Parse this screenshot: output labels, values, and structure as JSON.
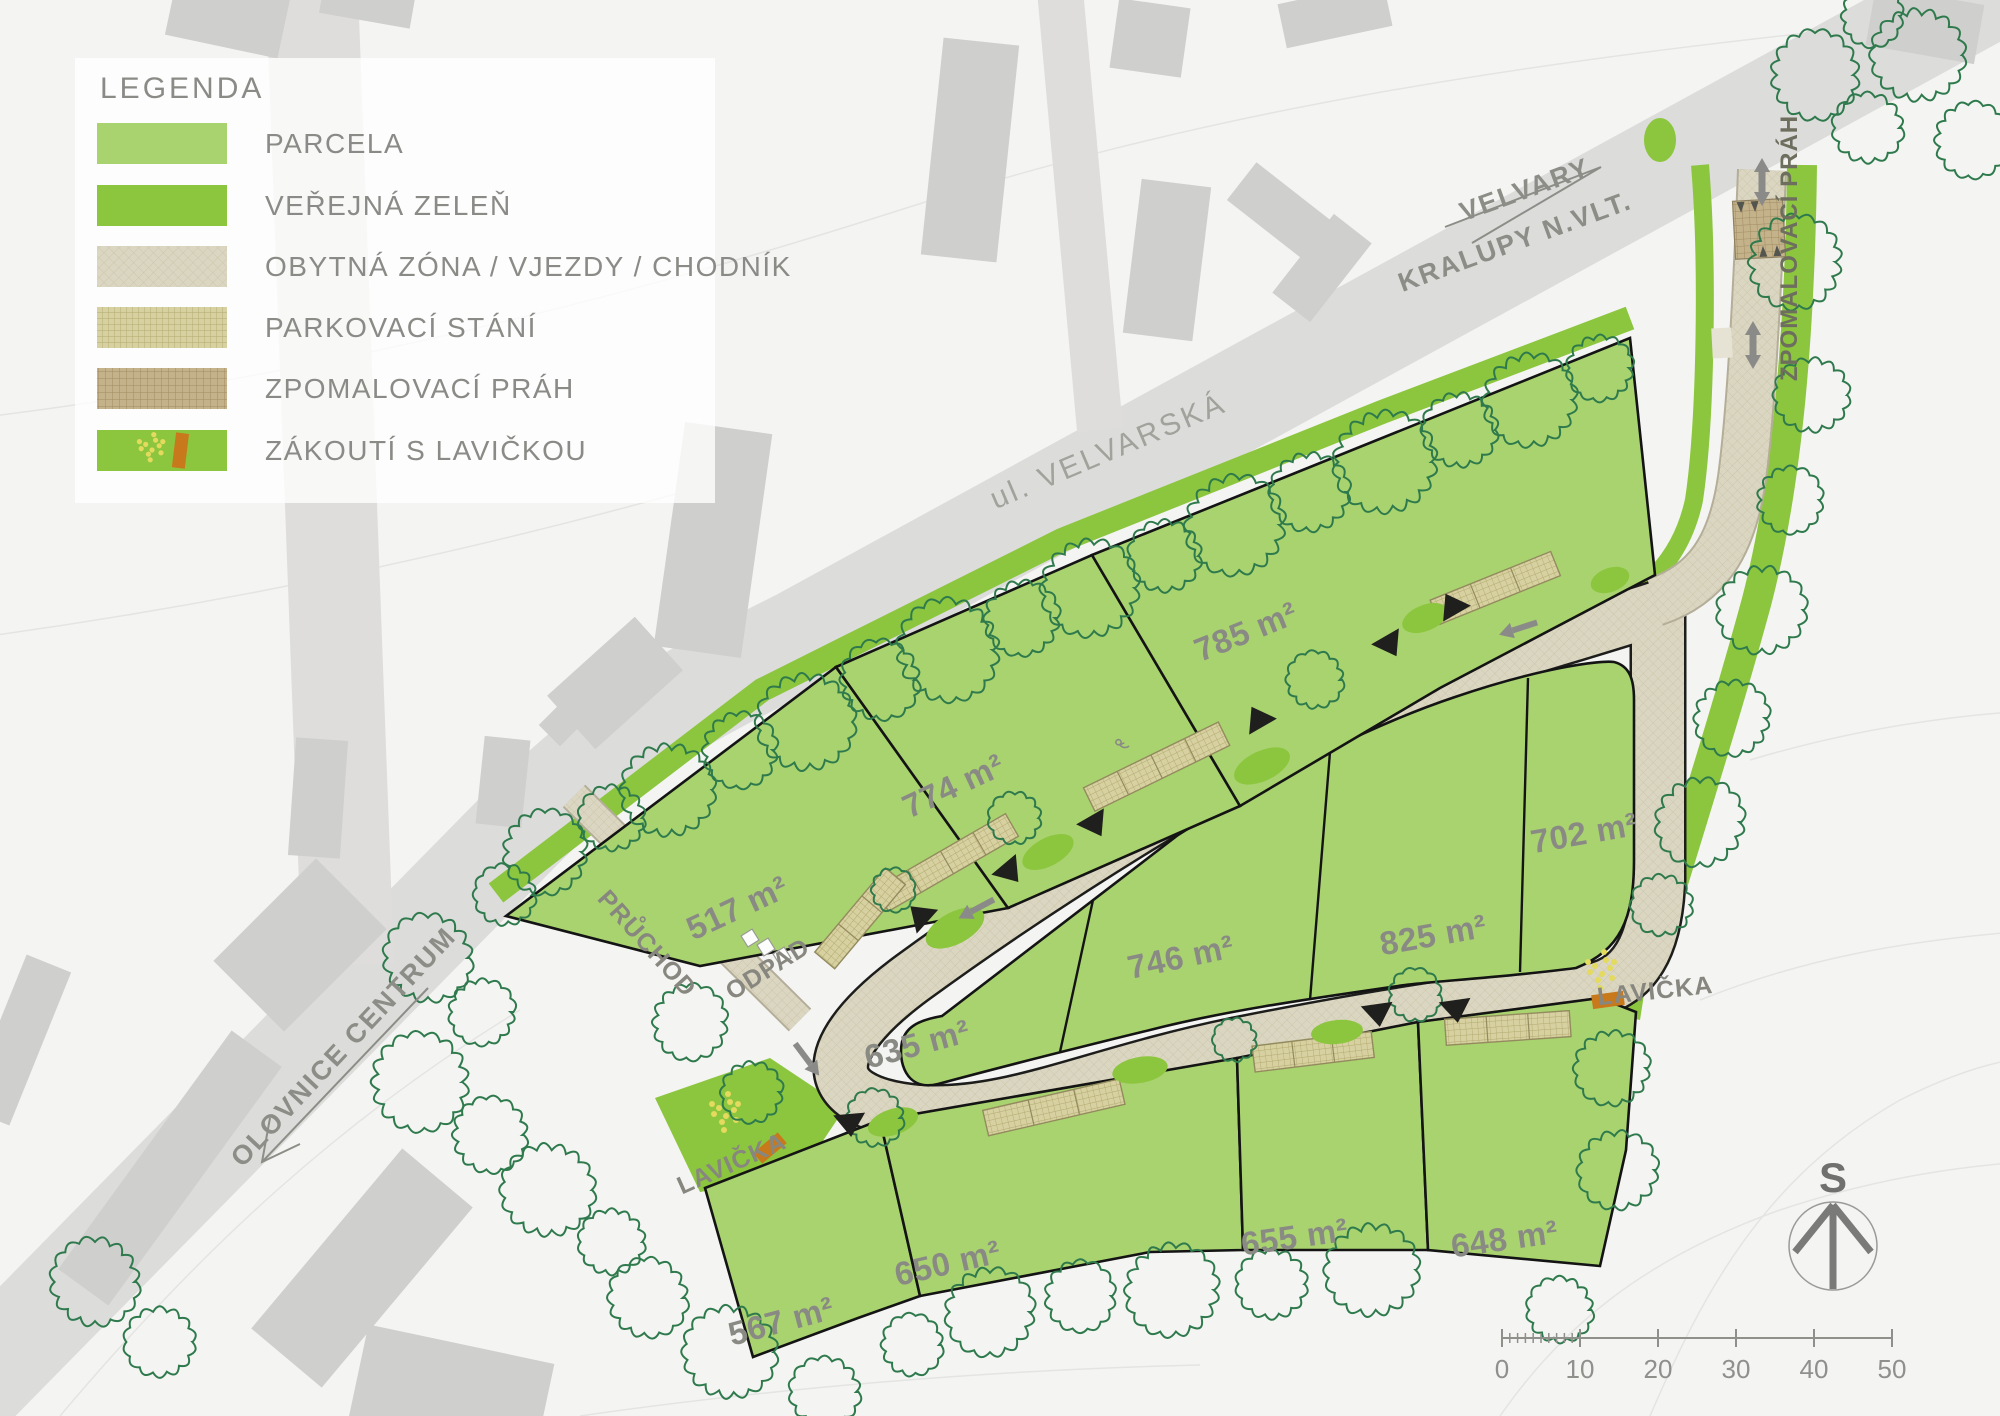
{
  "legend": {
    "title": "LEGENDA",
    "items": [
      {
        "id": "parcela",
        "label": "PARCELA"
      },
      {
        "id": "verejna-zelen",
        "label": "VEŘEJNÁ ZELEŇ"
      },
      {
        "id": "obytna-zona",
        "label": "OBYTNÁ ZÓNA / VJEZDY / CHODNÍK"
      },
      {
        "id": "parkovaci-stani",
        "label": "PARKOVACÍ STÁNÍ"
      },
      {
        "id": "zpomalovaci-prah",
        "label": "ZPOMALOVACÍ PRÁH"
      },
      {
        "id": "zakouti-s-lavickou",
        "label": "ZÁKOUTÍ S LAVIČKOU"
      }
    ]
  },
  "roads": {
    "street": "ul. VELVARSKÁ",
    "direction_ne": {
      "line1": "VELVARY",
      "line2": "KRALUPY N.VLT."
    },
    "direction_sw": "OLOVNICE CENTRUM"
  },
  "annotations": {
    "pruchod": "PRŮCHOD",
    "odpad": "ODPAD",
    "lavicka_west": "LAVIČKA",
    "lavicka_east": "LAVIČKA",
    "zpomalovaci_prah": "ZPOMALOVACÍ PRÁH"
  },
  "parcels": [
    {
      "id": "p517",
      "area": "517 m²"
    },
    {
      "id": "p774",
      "area": "774 m²"
    },
    {
      "id": "p785",
      "area": "785 m²"
    },
    {
      "id": "p635",
      "area": "635 m²"
    },
    {
      "id": "p746",
      "area": "746 m²"
    },
    {
      "id": "p825",
      "area": "825 m²"
    },
    {
      "id": "p702",
      "area": "702 m²"
    },
    {
      "id": "p567",
      "area": "567 m²"
    },
    {
      "id": "p650",
      "area": "650 m²"
    },
    {
      "id": "p655",
      "area": "655 m²"
    },
    {
      "id": "p648",
      "area": "648 m²"
    }
  ],
  "compass": {
    "north_label": "S"
  },
  "scale_bar": {
    "labels": [
      "0",
      "10",
      "20",
      "30",
      "40",
      "50"
    ]
  },
  "colors": {
    "parcel": "#a9d36f",
    "public_green": "#8cc63e",
    "road_surface": "#dbd6c1",
    "parking": "#d7d0a0",
    "speed_bump": "#c4b28b",
    "bench": "#c8791b",
    "bench_dots": "#e3da5e",
    "main_road": "#dcdcdb",
    "label_gray": "#8a8a85"
  }
}
